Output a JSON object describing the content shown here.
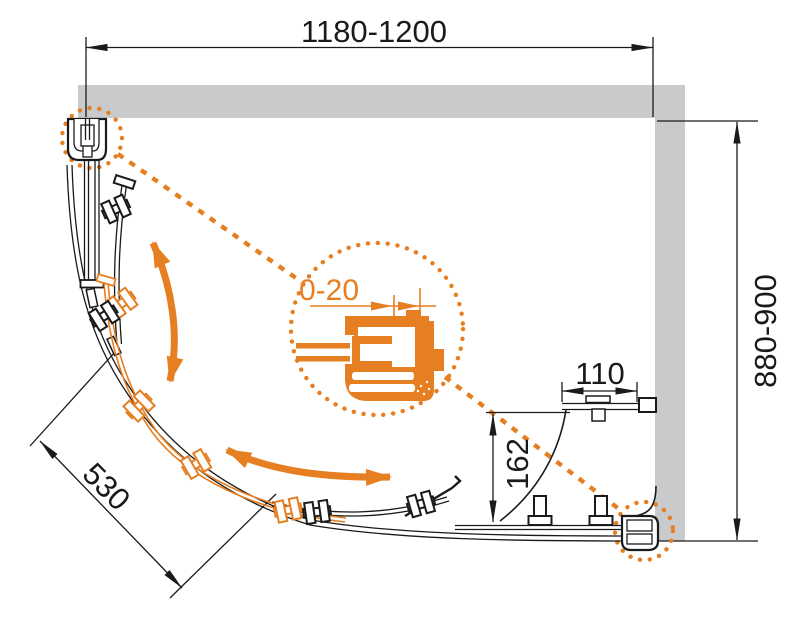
{
  "drawing": {
    "labels": {
      "width": "1180-1200",
      "depth": "880-900",
      "side_panel": "110",
      "panel_offset": "162",
      "door_opening": "530",
      "profile_adjustment": "0-20"
    },
    "colors": {
      "accent_orange": "#E67F22",
      "wall_gray": "#C8CACC",
      "line_black": "#1A1A1A"
    }
  }
}
